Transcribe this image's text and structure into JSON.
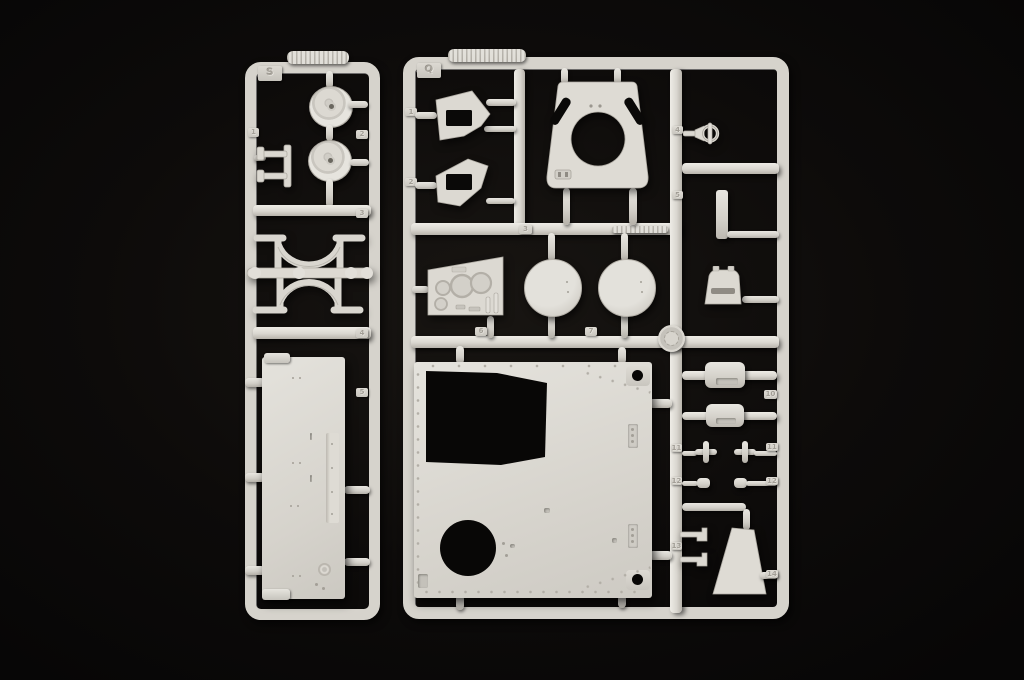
{
  "photo": {
    "type": "photograph",
    "subject": "Two ivory injection-molded model kit sprues (parts runners) photographed on a black background",
    "plastic_color": "#dcd9d2",
    "background_color": "#0a0908"
  },
  "sprue_s": {
    "label": "S",
    "gate_numbers": {
      "g1": "1",
      "g2": "2",
      "g3": "3",
      "g4": "4",
      "g5": "5"
    }
  },
  "sprue_q": {
    "label": "Q",
    "gate_numbers": {
      "g1": "1",
      "g2": "2",
      "g3": "3",
      "g4": "4",
      "g5": "5",
      "g6": "6",
      "g7": "7",
      "g10": "10",
      "g11a": "11",
      "g11b": "11",
      "g12a": "12",
      "g12b": "12",
      "g13": "13",
      "g14": "14"
    }
  }
}
